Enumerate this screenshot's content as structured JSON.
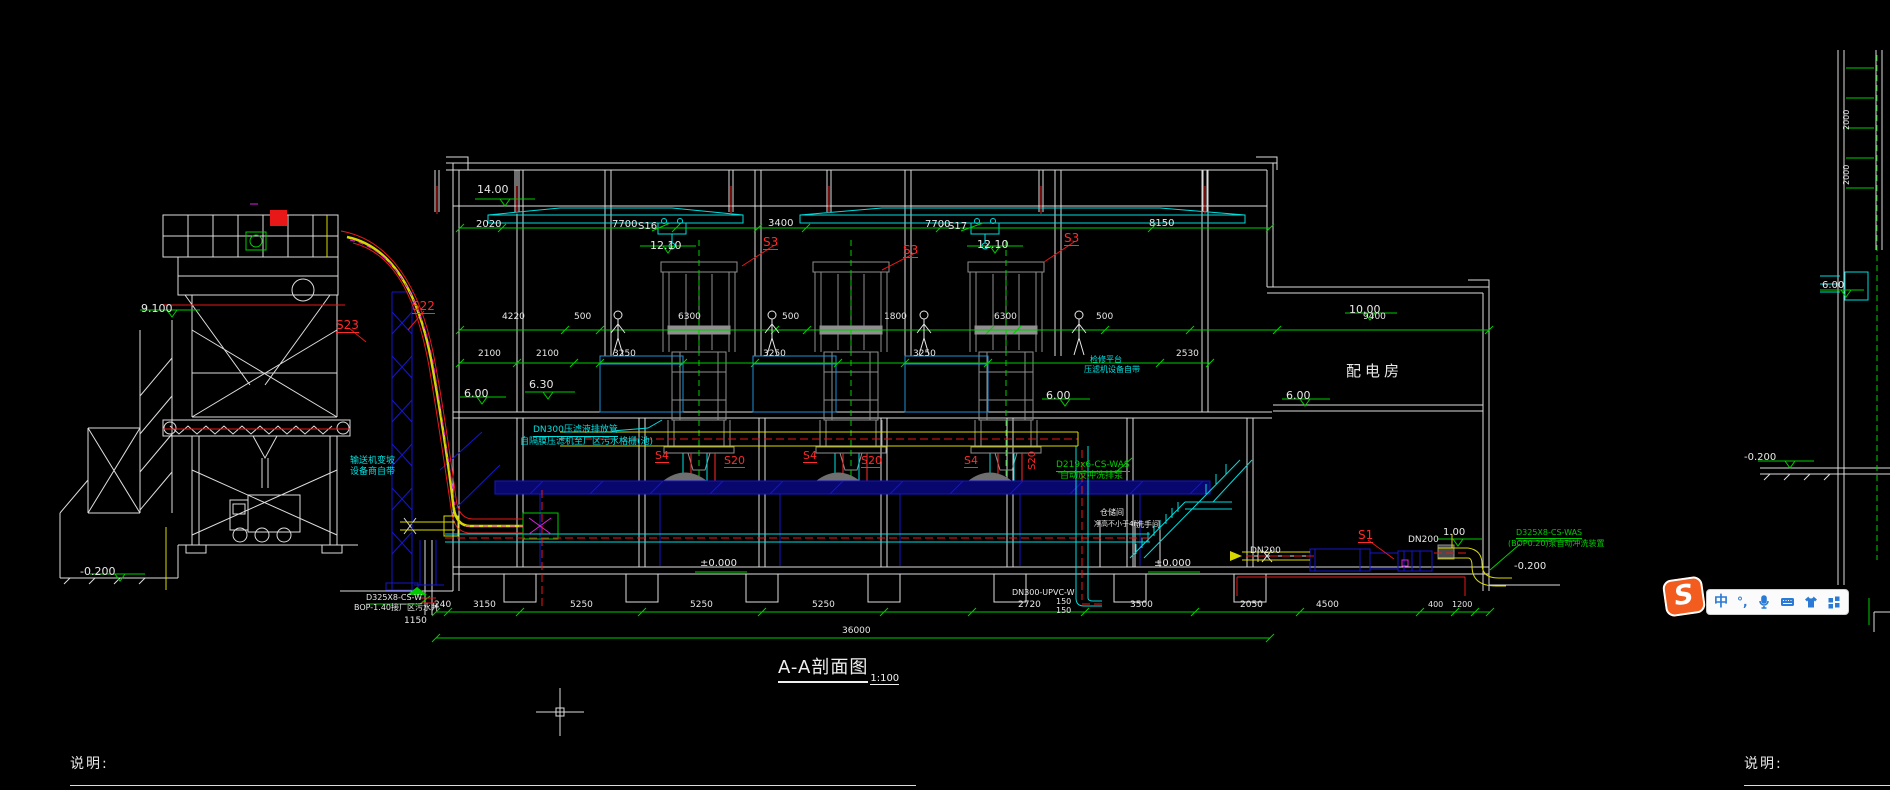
{
  "palette": {
    "w": "#e8e8e8",
    "r": "#ff2a2a",
    "g": "#00cc00",
    "c": "#00e0e0",
    "y": "#d8d800",
    "m": "#dd22dd"
  },
  "drawing": {
    "title": "A-A剖面图",
    "scale": "1:100"
  },
  "rooms": {
    "power_room": "配电房"
  },
  "notes": {
    "left_label": "说明:",
    "right_label": "说明:"
  },
  "ime_toolbar": {
    "logo": "S",
    "mode": "中",
    "punct": "°,",
    "icons": [
      "mic-icon",
      "keyboard-icon",
      "skin-icon",
      "menu-grid-icon"
    ]
  },
  "annotations": [
    {
      "t": "9.100",
      "x": 141,
      "y": 303,
      "s": 11,
      "c": "w"
    },
    {
      "t": "S23",
      "x": 336,
      "y": 319,
      "s": 12,
      "c": "r",
      "u": 1
    },
    {
      "t": "S22",
      "x": 412,
      "y": 300,
      "s": 12,
      "c": "r",
      "u": 1
    },
    {
      "t": "输送机变坡",
      "x": 350,
      "y": 457,
      "s": 9,
      "c": "c"
    },
    {
      "t": "设备商自带",
      "x": 350,
      "y": 468,
      "s": 9,
      "c": "c"
    },
    {
      "t": "-0.200",
      "x": 80,
      "y": 566,
      "s": 11,
      "c": "w"
    },
    {
      "t": "D325X8-CS-W",
      "x": 366,
      "y": 594,
      "s": 8,
      "c": "w"
    },
    {
      "t": "BOP-1.40接厂区污水井",
      "x": 354,
      "y": 604,
      "s": 8,
      "c": "w"
    },
    {
      "t": "1150",
      "x": 404,
      "y": 617,
      "s": 9,
      "c": "w"
    },
    {
      "t": "14.00",
      "x": 477,
      "y": 184,
      "s": 11,
      "c": "w"
    },
    {
      "t": "2020",
      "x": 476,
      "y": 220,
      "s": 10,
      "c": "w"
    },
    {
      "t": "7700",
      "x": 612,
      "y": 220,
      "s": 10,
      "c": "w"
    },
    {
      "t": "S16",
      "x": 638,
      "y": 222,
      "s": 10,
      "c": "w"
    },
    {
      "t": "12.10",
      "x": 650,
      "y": 240,
      "s": 11,
      "c": "w"
    },
    {
      "t": "3400",
      "x": 768,
      "y": 219,
      "s": 10,
      "c": "w"
    },
    {
      "t": "7700",
      "x": 925,
      "y": 220,
      "s": 10,
      "c": "w"
    },
    {
      "t": "S17",
      "x": 948,
      "y": 222,
      "s": 10,
      "c": "w"
    },
    {
      "t": "12.10",
      "x": 977,
      "y": 239,
      "s": 11,
      "c": "w"
    },
    {
      "t": "8150",
      "x": 1149,
      "y": 219,
      "s": 10,
      "c": "w"
    },
    {
      "t": "S3",
      "x": 763,
      "y": 236,
      "s": 12,
      "c": "r",
      "u": 1
    },
    {
      "t": "S3",
      "x": 903,
      "y": 244,
      "s": 12,
      "c": "r",
      "u": 1
    },
    {
      "t": "S3",
      "x": 1064,
      "y": 232,
      "s": 12,
      "c": "r",
      "u": 1
    },
    {
      "t": "4220",
      "x": 502,
      "y": 313,
      "s": 9,
      "c": "w"
    },
    {
      "t": "500",
      "x": 574,
      "y": 313,
      "s": 9,
      "c": "w"
    },
    {
      "t": "6300",
      "x": 678,
      "y": 313,
      "s": 9,
      "c": "w"
    },
    {
      "t": "500",
      "x": 782,
      "y": 313,
      "s": 9,
      "c": "w"
    },
    {
      "t": "1800",
      "x": 884,
      "y": 313,
      "s": 9,
      "c": "w"
    },
    {
      "t": "6300",
      "x": 994,
      "y": 313,
      "s": 9,
      "c": "w"
    },
    {
      "t": "500",
      "x": 1096,
      "y": 313,
      "s": 9,
      "c": "w"
    },
    {
      "t": "9400",
      "x": 1363,
      "y": 313,
      "s": 9,
      "c": "w"
    },
    {
      "t": "2100",
      "x": 478,
      "y": 350,
      "s": 9,
      "c": "w"
    },
    {
      "t": "2100",
      "x": 536,
      "y": 350,
      "s": 9,
      "c": "w"
    },
    {
      "t": "3250",
      "x": 613,
      "y": 350,
      "s": 9,
      "c": "w"
    },
    {
      "t": "3250",
      "x": 763,
      "y": 350,
      "s": 9,
      "c": "w"
    },
    {
      "t": "3250",
      "x": 913,
      "y": 350,
      "s": 9,
      "c": "w"
    },
    {
      "t": "2530",
      "x": 1176,
      "y": 350,
      "s": 9,
      "c": "w"
    },
    {
      "t": "6.00",
      "x": 464,
      "y": 388,
      "s": 11,
      "c": "w"
    },
    {
      "t": "6.30",
      "x": 529,
      "y": 379,
      "s": 11,
      "c": "w"
    },
    {
      "t": "6.00",
      "x": 1046,
      "y": 390,
      "s": 11,
      "c": "w"
    },
    {
      "t": "6.00",
      "x": 1286,
      "y": 390,
      "s": 11,
      "c": "w"
    },
    {
      "t": "10.00",
      "x": 1349,
      "y": 304,
      "s": 11,
      "c": "w"
    },
    {
      "t": "±0.000",
      "x": 700,
      "y": 559,
      "s": 10,
      "c": "w"
    },
    {
      "t": "±0.000",
      "x": 1154,
      "y": 559,
      "s": 10,
      "c": "w"
    },
    {
      "t": "DN300压滤液排放管",
      "x": 533,
      "y": 426,
      "s": 9,
      "c": "c",
      "u": 1
    },
    {
      "t": "自隔膜压滤机至厂区污水格栅(池)",
      "x": 520,
      "y": 438,
      "s": 9,
      "c": "c"
    },
    {
      "t": "S4",
      "x": 655,
      "y": 450,
      "s": 11,
      "c": "r",
      "u": 1
    },
    {
      "t": "S20",
      "x": 724,
      "y": 455,
      "s": 11,
      "c": "r",
      "u": 1
    },
    {
      "t": "S4",
      "x": 803,
      "y": 450,
      "s": 11,
      "c": "r",
      "u": 1
    },
    {
      "t": "S20",
      "x": 861,
      "y": 455,
      "s": 11,
      "c": "r",
      "u": 1
    },
    {
      "t": "S4",
      "x": 964,
      "y": 455,
      "s": 11,
      "c": "r",
      "u": 1
    },
    {
      "t": "S20",
      "x": 1028,
      "y": 470,
      "s": 10,
      "c": "r",
      "r": -90
    },
    {
      "t": "D219x6-CS-WAS",
      "x": 1056,
      "y": 461,
      "s": 9,
      "c": "g",
      "u": 1
    },
    {
      "t": "自动反冲洗排泵",
      "x": 1060,
      "y": 472,
      "s": 9,
      "c": "g"
    },
    {
      "t": "检修平台",
      "x": 1090,
      "y": 356,
      "s": 8,
      "c": "c"
    },
    {
      "t": "压滤机设备自带",
      "x": 1084,
      "y": 366,
      "s": 8,
      "c": "c"
    },
    {
      "t": "仓储间",
      "x": 1100,
      "y": 509,
      "s": 8,
      "c": "w"
    },
    {
      "t": "净高不小于4m",
      "x": 1094,
      "y": 521,
      "s": 7,
      "c": "w"
    },
    {
      "t": "洗手间",
      "x": 1136,
      "y": 521,
      "s": 8,
      "c": "w"
    },
    {
      "t": "DN300-UPVC-W",
      "x": 1012,
      "y": 589,
      "s": 8,
      "c": "w"
    },
    {
      "t": "150",
      "x": 1056,
      "y": 598,
      "s": 8,
      "c": "w"
    },
    {
      "t": "150",
      "x": 1056,
      "y": 607,
      "s": 8,
      "c": "w"
    },
    {
      "t": "DN200",
      "x": 1250,
      "y": 547,
      "s": 9,
      "c": "w"
    },
    {
      "t": "S1",
      "x": 1358,
      "y": 529,
      "s": 12,
      "c": "r",
      "u": 1
    },
    {
      "t": "DN200",
      "x": 1408,
      "y": 536,
      "s": 9,
      "c": "w"
    },
    {
      "t": "1.00",
      "x": 1443,
      "y": 528,
      "s": 10,
      "c": "w"
    },
    {
      "t": "D325X8-CS-WAS",
      "x": 1516,
      "y": 529,
      "s": 8,
      "c": "g",
      "u": 1
    },
    {
      "t": "(BOP0.20)泵自动冲洗装置",
      "x": 1508,
      "y": 540,
      "s": 8,
      "c": "g"
    },
    {
      "t": "-0.200",
      "x": 1514,
      "y": 562,
      "s": 10,
      "c": "w"
    },
    {
      "t": "-0.200",
      "x": 1744,
      "y": 453,
      "s": 10,
      "c": "w"
    },
    {
      "t": "240",
      "x": 434,
      "y": 601,
      "s": 9,
      "c": "w"
    },
    {
      "t": "3150",
      "x": 473,
      "y": 601,
      "s": 9,
      "c": "w"
    },
    {
      "t": "5250",
      "x": 570,
      "y": 601,
      "s": 9,
      "c": "w"
    },
    {
      "t": "5250",
      "x": 690,
      "y": 601,
      "s": 9,
      "c": "w"
    },
    {
      "t": "5250",
      "x": 812,
      "y": 601,
      "s": 9,
      "c": "w"
    },
    {
      "t": "2720",
      "x": 1018,
      "y": 601,
      "s": 9,
      "c": "w"
    },
    {
      "t": "3500",
      "x": 1130,
      "y": 601,
      "s": 9,
      "c": "w"
    },
    {
      "t": "2050",
      "x": 1240,
      "y": 601,
      "s": 9,
      "c": "w"
    },
    {
      "t": "4500",
      "x": 1316,
      "y": 601,
      "s": 9,
      "c": "w"
    },
    {
      "t": "400",
      "x": 1428,
      "y": 601,
      "s": 8,
      "c": "w"
    },
    {
      "t": "1200",
      "x": 1452,
      "y": 601,
      "s": 8,
      "c": "w"
    },
    {
      "t": "36000",
      "x": 842,
      "y": 627,
      "s": 9,
      "c": "w"
    },
    {
      "t": "2000",
      "x": 1843,
      "y": 130,
      "s": 8,
      "c": "w",
      "r": -90
    },
    {
      "t": "2000",
      "x": 1843,
      "y": 185,
      "s": 8,
      "c": "w",
      "r": -90
    },
    {
      "t": "6.00",
      "x": 1822,
      "y": 281,
      "s": 10,
      "c": "w"
    }
  ]
}
